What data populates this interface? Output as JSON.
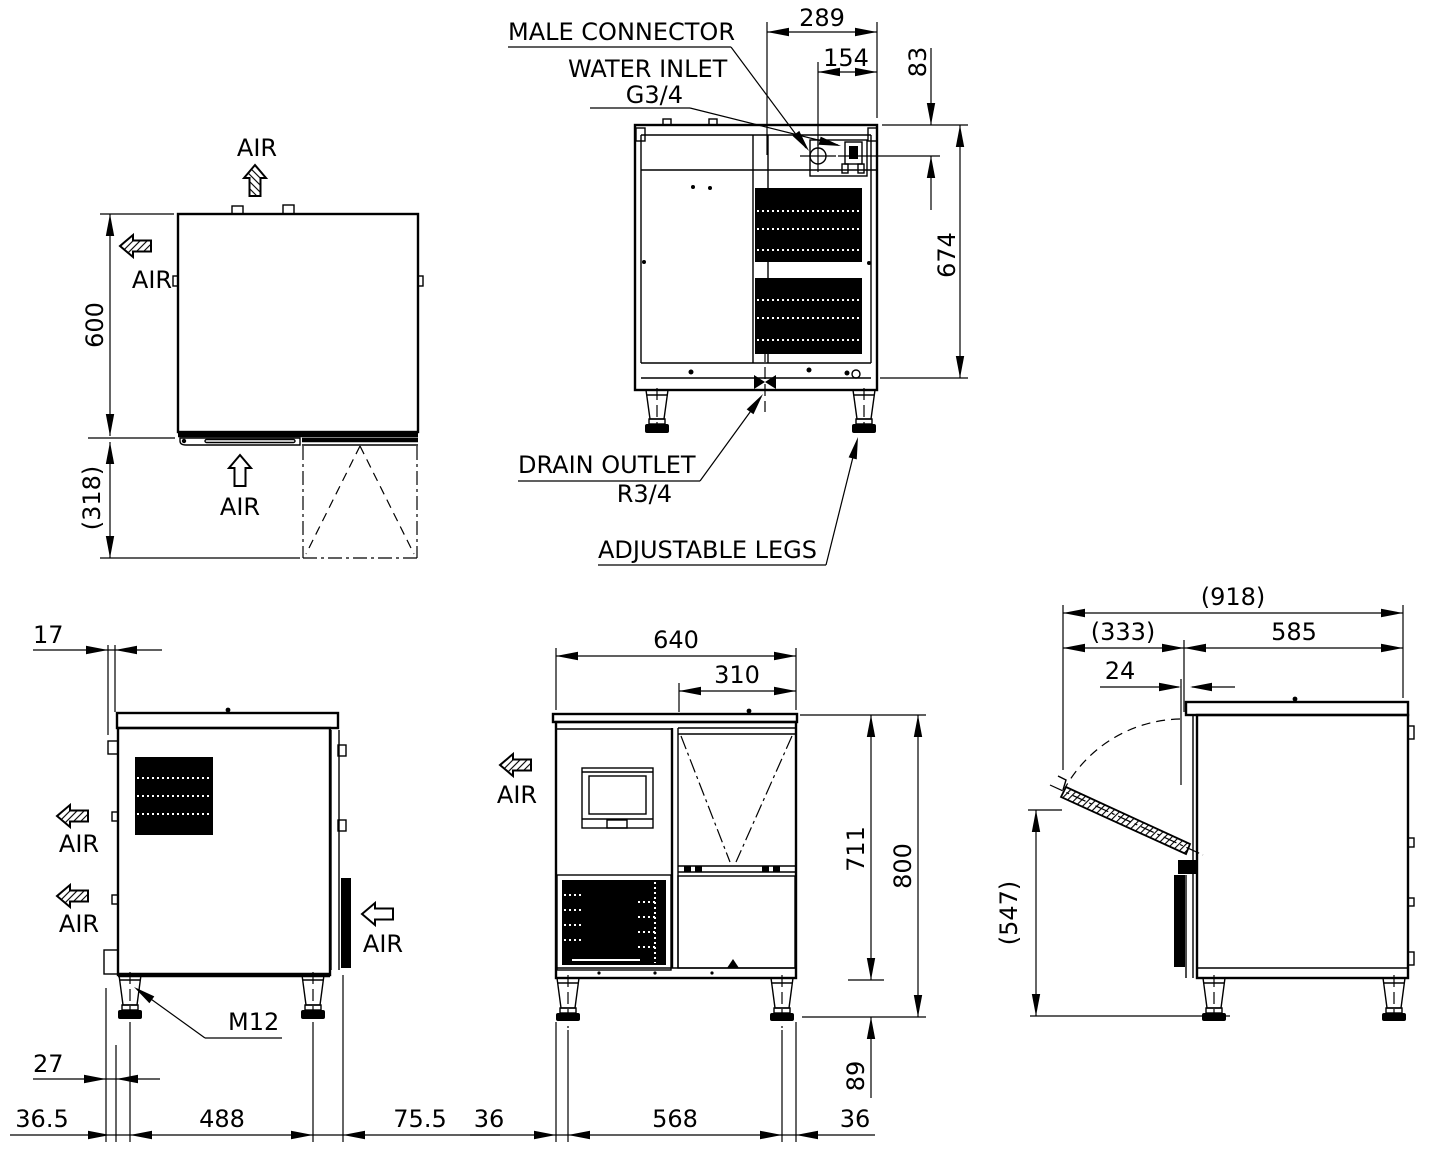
{
  "drawing": {
    "air_label": "AIR",
    "colors": {
      "ink": "#000000",
      "background": "#ffffff"
    },
    "top_view": {
      "dim_depth": "600",
      "dim_door_open": "(318)"
    },
    "rear_view": {
      "label_male_connector": "MALE CONNECTOR",
      "label_water_inlet": "WATER INLET",
      "label_water_inlet_thread": "G3/4",
      "label_drain_outlet": "DRAIN OUTLET",
      "label_drain_thread": "R3/4",
      "label_adjustable_legs": "ADJUSTABLE LEGS",
      "dim_connector_span": "289",
      "dim_inlet_offset": "154",
      "dim_inlet_drop": "83",
      "dim_body_height": "674"
    },
    "left_view": {
      "dim_rear_gap": "17",
      "dim_leg_offset": "27",
      "dim_rear_leg": "36.5",
      "dim_leg_span": "488",
      "dim_front_leg": "75.5",
      "label_leg_thread": "M12"
    },
    "front_view": {
      "dim_width": "640",
      "dim_bin_width": "310",
      "dim_body_height": "711",
      "dim_total_height": "800",
      "dim_leg_height": "89",
      "dim_left_leg": "36",
      "dim_leg_span": "568",
      "dim_right_leg": "36"
    },
    "right_view": {
      "dim_total_depth": "(918)",
      "dim_door_swing": "(333)",
      "dim_body_depth": "585",
      "dim_door_offset": "24",
      "dim_door_tip_height": "(547)"
    }
  }
}
